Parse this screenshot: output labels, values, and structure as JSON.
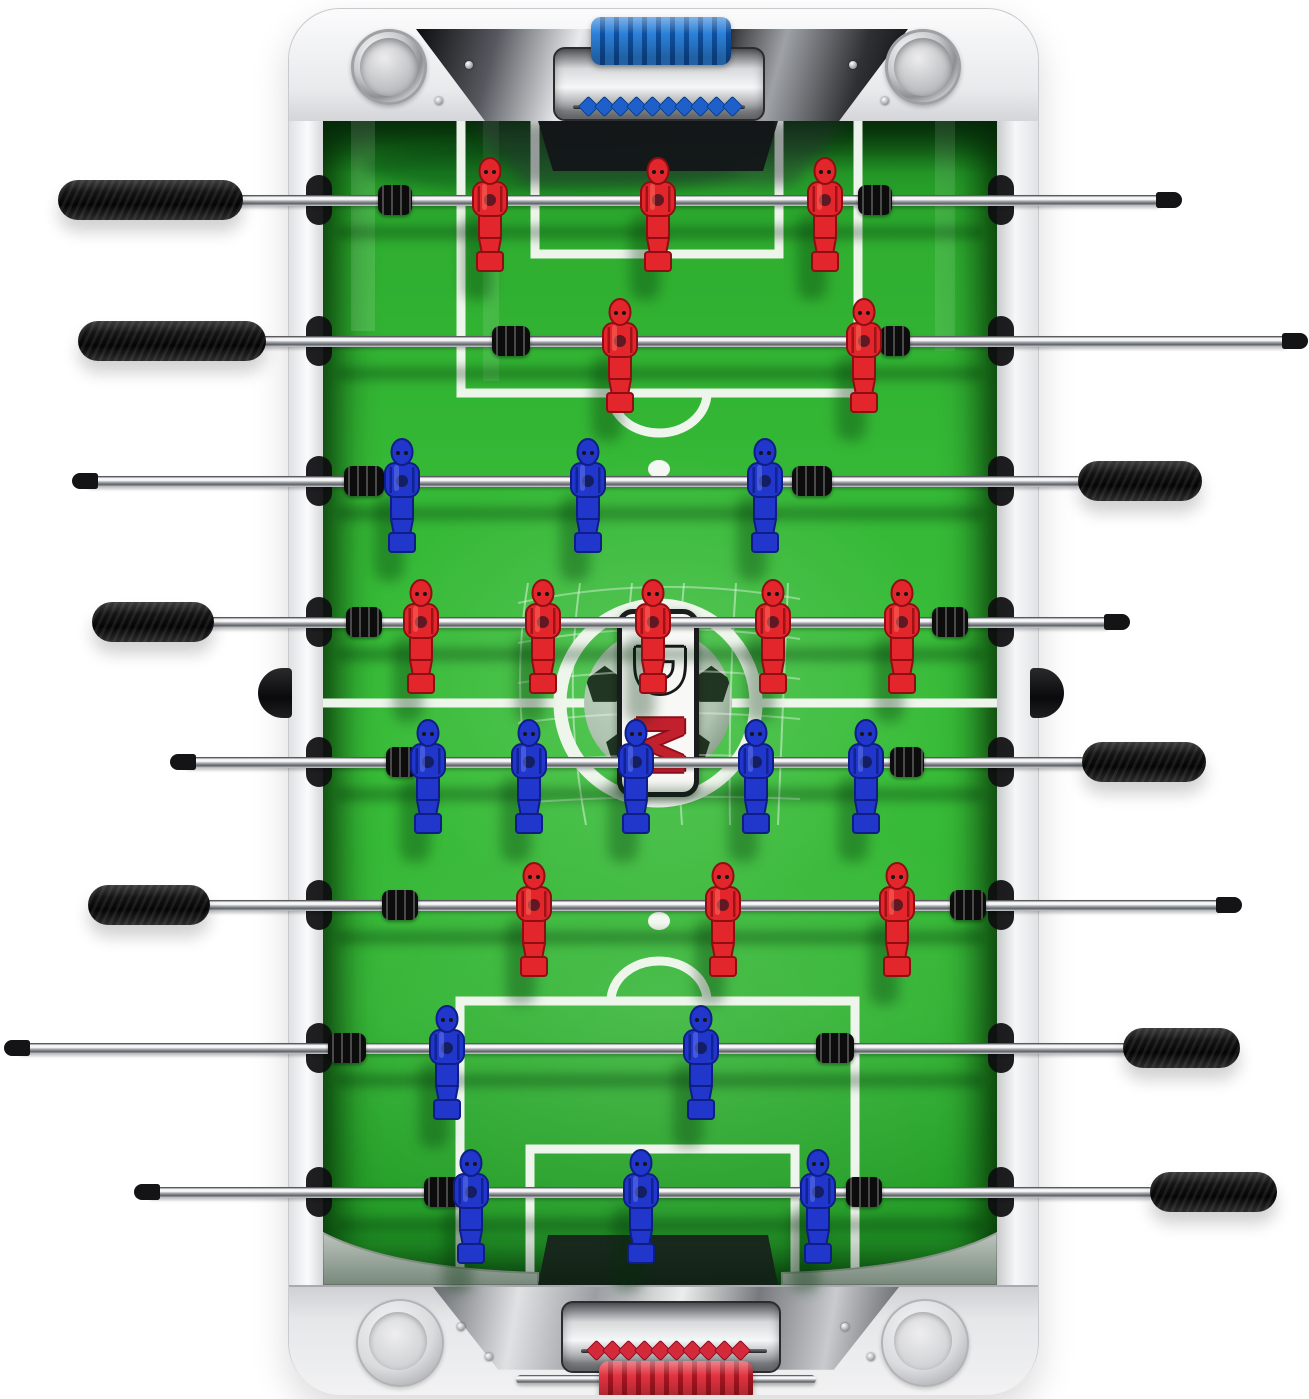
{
  "meta": {
    "description": "Top-down product view of a white tabletop foosball (table soccer) table with chrome rods, black grip handles, red vs blue molded players, green printed soccer pitch, chrome goal housings with score-bead counters and team-colored grips at each end"
  },
  "logo": {
    "letter_top": "D",
    "letter_bottom": "M"
  },
  "colors": {
    "field_line": "#f4f8f2",
    "goal_mouth": "#131518",
    "ramp_gray": "#ccd2cd"
  },
  "teams": {
    "red": {
      "body": "#e3262b",
      "dark": "#8f0e13",
      "light": "#ff7a66"
    },
    "blue": {
      "body": "#2136cb",
      "dark": "#0e1e86",
      "light": "#6f86f2"
    }
  },
  "header": {
    "grip_main": "#2b80d9",
    "grip_dark": "#0d4fa0",
    "bead_color": "#1e5fc9",
    "bead_dark": "#0c3f8e",
    "bead_count": 10
  },
  "footer": {
    "grip_main": "#e23340",
    "grip_dark": "#a81420",
    "bead_color": "#d3293a",
    "bead_dark": "#8d1020",
    "bead_count": 10
  },
  "rods": [
    {
      "y": 200,
      "team": "red",
      "rod": [
        228,
        1162
      ],
      "handle": [
        58,
        243
      ],
      "handle_side": "left",
      "cap": [
        1156,
        1182
      ],
      "cap_side": "right",
      "players": [
        490,
        658,
        825
      ],
      "bumpers": [
        [
          378,
          34
        ],
        [
          858,
          34
        ]
      ]
    },
    {
      "y": 341,
      "team": "red",
      "rod": [
        252,
        1288
      ],
      "handle": [
        78,
        266
      ],
      "handle_side": "left",
      "cap": [
        1282,
        1308
      ],
      "cap_side": "right",
      "players": [
        620,
        864
      ],
      "bumpers": [
        [
          492,
          38
        ],
        [
          880,
          30
        ]
      ]
    },
    {
      "y": 481,
      "team": "blue",
      "rod": [
        86,
        1082
      ],
      "handle": [
        1078,
        1202
      ],
      "handle_side": "right",
      "cap": [
        72,
        98
      ],
      "cap_side": "left",
      "players": [
        402,
        588,
        765
      ],
      "bumpers": [
        [
          344,
          40
        ],
        [
          792,
          40
        ]
      ]
    },
    {
      "y": 622,
      "team": "red",
      "rod": [
        202,
        1110
      ],
      "handle": [
        92,
        214
      ],
      "handle_side": "left",
      "cap": [
        1104,
        1130
      ],
      "cap_side": "right",
      "players": [
        421,
        543,
        653,
        773,
        902
      ],
      "bumpers": [
        [
          346,
          36
        ],
        [
          932,
          36
        ]
      ]
    },
    {
      "y": 762,
      "team": "blue",
      "rod": [
        184,
        1086
      ],
      "handle": [
        1082,
        1206
      ],
      "handle_side": "right",
      "cap": [
        170,
        196
      ],
      "cap_side": "left",
      "players": [
        428,
        529,
        636,
        756,
        866
      ],
      "bumpers": [
        [
          386,
          32
        ],
        [
          890,
          34
        ]
      ]
    },
    {
      "y": 905,
      "team": "red",
      "rod": [
        198,
        1222
      ],
      "handle": [
        88,
        210
      ],
      "handle_side": "left",
      "cap": [
        1216,
        1242
      ],
      "cap_side": "right",
      "players": [
        534,
        723,
        897
      ],
      "bumpers": [
        [
          382,
          36
        ],
        [
          950,
          36
        ]
      ]
    },
    {
      "y": 1048,
      "team": "blue",
      "rod": [
        18,
        1128
      ],
      "handle": [
        1123,
        1240
      ],
      "handle_side": "right",
      "cap": [
        4,
        30
      ],
      "cap_side": "left",
      "players": [
        447,
        701
      ],
      "bumpers": [
        [
          328,
          38
        ],
        [
          816,
          38
        ]
      ]
    },
    {
      "y": 1192,
      "team": "blue",
      "rod": [
        148,
        1154
      ],
      "handle": [
        1150,
        1277
      ],
      "handle_side": "right",
      "cap": [
        134,
        160
      ],
      "cap_side": "left",
      "players": [
        471,
        641,
        818
      ],
      "bumpers": [
        [
          424,
          40
        ],
        [
          846,
          36
        ]
      ]
    }
  ],
  "field_geometry": {
    "center": [
      335,
      582
    ],
    "center_circle_r": 98,
    "ball_r": 74,
    "line_w": 9,
    "penalty_box_top": {
      "x1": 138,
      "x2": 535,
      "depth": 272
    },
    "goal_box_top": {
      "x1": 212,
      "x2": 456,
      "depth": 133
    },
    "spot_top": [
      336,
      348
    ],
    "penalty_box_bottom": {
      "x1": 137,
      "x2": 532,
      "top": 880
    },
    "goal_box_bottom": {
      "x1": 207,
      "x2": 472,
      "top": 1028
    },
    "spot_bottom": [
      336,
      800
    ]
  }
}
